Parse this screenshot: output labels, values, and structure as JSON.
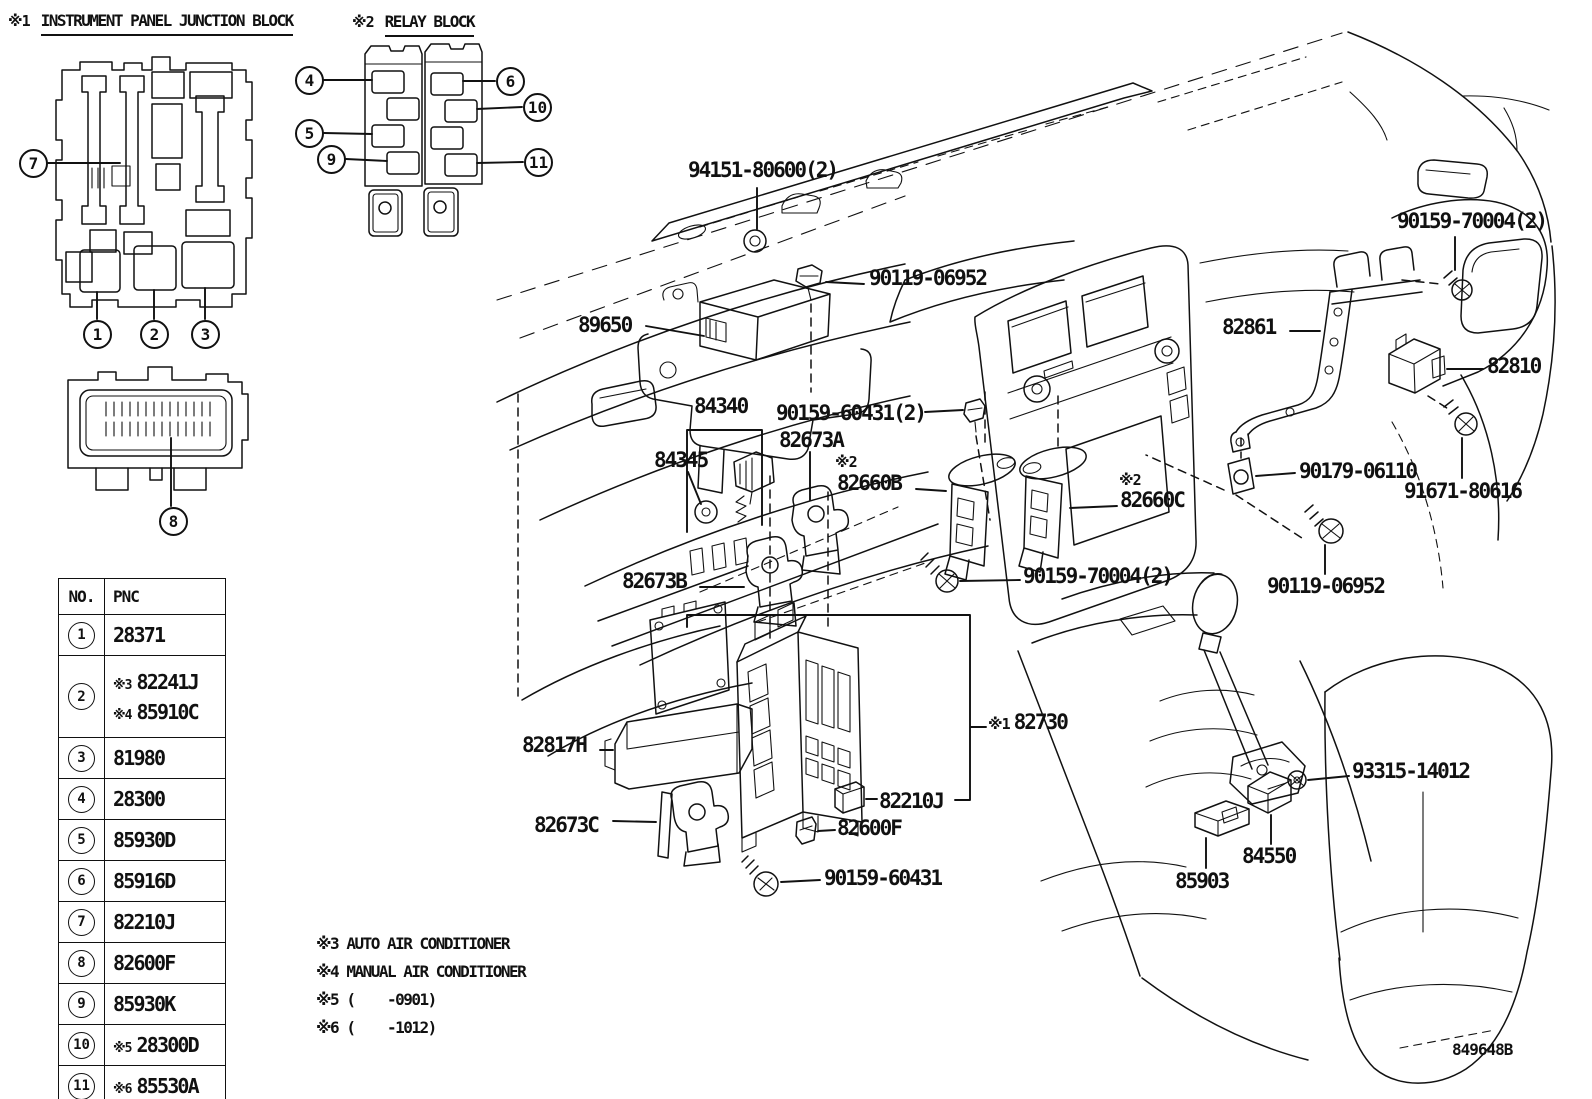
{
  "titles": {
    "junction_prefix": "※1",
    "junction": "INSTRUMENT PANEL JUNCTION BLOCK",
    "relay_prefix": "※2",
    "relay": "RELAY BLOCK"
  },
  "callouts": {
    "c1": "1",
    "c2": "2",
    "c3": "3",
    "c4": "4",
    "c5": "5",
    "c6": "6",
    "c7": "7",
    "c8": "8",
    "c9": "9",
    "c10": "10",
    "c11": "11"
  },
  "table": {
    "headers": {
      "no": "NO.",
      "pnc": "PNC"
    },
    "rows": [
      {
        "no": "1",
        "lines": [
          {
            "prefix": "",
            "code": "28371"
          }
        ]
      },
      {
        "no": "2",
        "lines": [
          {
            "prefix": "※3",
            "code": "82241J"
          },
          {
            "prefix": "※4",
            "code": "85910C"
          }
        ]
      },
      {
        "no": "3",
        "lines": [
          {
            "prefix": "",
            "code": "81980"
          }
        ]
      },
      {
        "no": "4",
        "lines": [
          {
            "prefix": "",
            "code": "28300"
          }
        ]
      },
      {
        "no": "5",
        "lines": [
          {
            "prefix": "",
            "code": "85930D"
          }
        ]
      },
      {
        "no": "6",
        "lines": [
          {
            "prefix": "",
            "code": "85916D"
          }
        ]
      },
      {
        "no": "7",
        "lines": [
          {
            "prefix": "",
            "code": "82210J"
          }
        ]
      },
      {
        "no": "8",
        "lines": [
          {
            "prefix": "",
            "code": "82600F"
          }
        ]
      },
      {
        "no": "9",
        "lines": [
          {
            "prefix": "",
            "code": "85930K"
          }
        ]
      },
      {
        "no": "10",
        "lines": [
          {
            "prefix": "※5",
            "code": "28300D"
          }
        ]
      },
      {
        "no": "11",
        "lines": [
          {
            "prefix": "※6",
            "code": "85530A"
          }
        ]
      }
    ]
  },
  "part_labels": {
    "p94151": "94151-80600(2)",
    "p90119_top": "90119-06952",
    "p89650": "89650",
    "p84340": "84340",
    "p90159_60431_2": "90159-60431(2)",
    "p84345": "84345",
    "p82673A": "82673A",
    "note2": "※2",
    "p82660B": "82660B",
    "p82660C": "82660C",
    "p82673B": "82673B",
    "p90159_70004": "90159-70004(2)",
    "p90179": "90179-06110",
    "p90119_bot": "90119-06952",
    "p82861": "82861",
    "p82810": "82810",
    "p91671": "91671-80616",
    "p82817H": "82817H",
    "p82673C": "82673C",
    "p82730_prefix": "※1",
    "p82730": "82730",
    "p82210J": "82210J",
    "p82600F": "82600F",
    "p90159_60431": "90159-60431",
    "p85903": "85903",
    "p84550": "84550",
    "p93315": "93315-14012"
  },
  "notes": {
    "n3": "※3 AUTO AIR CONDITIONER",
    "n4": "※4 MANUAL AIR CONDITIONER",
    "n5": "※5 (    -0901)",
    "n6": "※6 (    -1012)"
  },
  "doc_number": "849648B",
  "colors": {
    "ink": "#111111",
    "paper": "#ffffff"
  }
}
